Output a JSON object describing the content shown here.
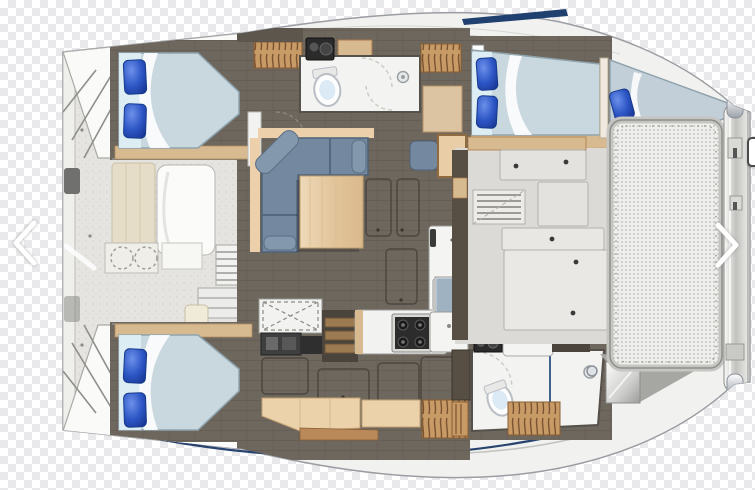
{
  "page": {
    "type": "image-carousel-slide",
    "description": "Top-down floor plan drawing of a catamaran sailing yacht shown over a transparency checkerboard background"
  },
  "carousel": {
    "prev_label": "Previous image",
    "next_label": "Next image",
    "prev_glyph": "❮",
    "next_glyph": "❯"
  },
  "floorplan": {
    "vessel": "catamaran",
    "view": "top-down interior layout, bow to the right",
    "areas": {
      "boat": "Catamaran hull silhouette",
      "aft_cockpit": "Aft cockpit with bench seating, sunpad and table with two stools",
      "transom_steps": "Transom boarding steps",
      "port_aft_cabin": "Port aft cabin with double berth and two blue pillows",
      "port_head": "Port head with toilet, vanity sink and shower",
      "port_forward_cabin": "Port forward cabin with double berth",
      "forepeak_berth": "Forepeak berth in the bow",
      "salon": "Salon with L-shaped settee and wood table",
      "forward_door": "Forward salon door with window",
      "galley": "Galley with gas cooktop, sink, counters and mirror",
      "starboard_aft_cabin": "Starboard aft cabin with double berth and two blue pillows",
      "starboard_head": "Starboard forward head with toilet, vanity and shower",
      "forward_cockpit": "Forward cockpit with lockers and bench seats",
      "trampoline": "Bow trampoline mesh",
      "crossbeam": "Forward crossbeam with anchor fittings",
      "hanging_locker": "Hanging locker",
      "companionway": "Companionway steps"
    }
  },
  "colors": {
    "pillow_blue": "#2c55c4",
    "mattress": "#c9d7de",
    "sofa_blue": "#74899f",
    "table_wood": "#e4c79d",
    "shelf_wood": "#d8ba90",
    "locker_wood": "#c79a66",
    "floor_taupe": "#6e675e",
    "deck_white": "#f1f1ef",
    "cockpit_gray": "#e6e4e0",
    "navy_trim": "#20406f",
    "checker_gray": "#e9e9eb"
  }
}
